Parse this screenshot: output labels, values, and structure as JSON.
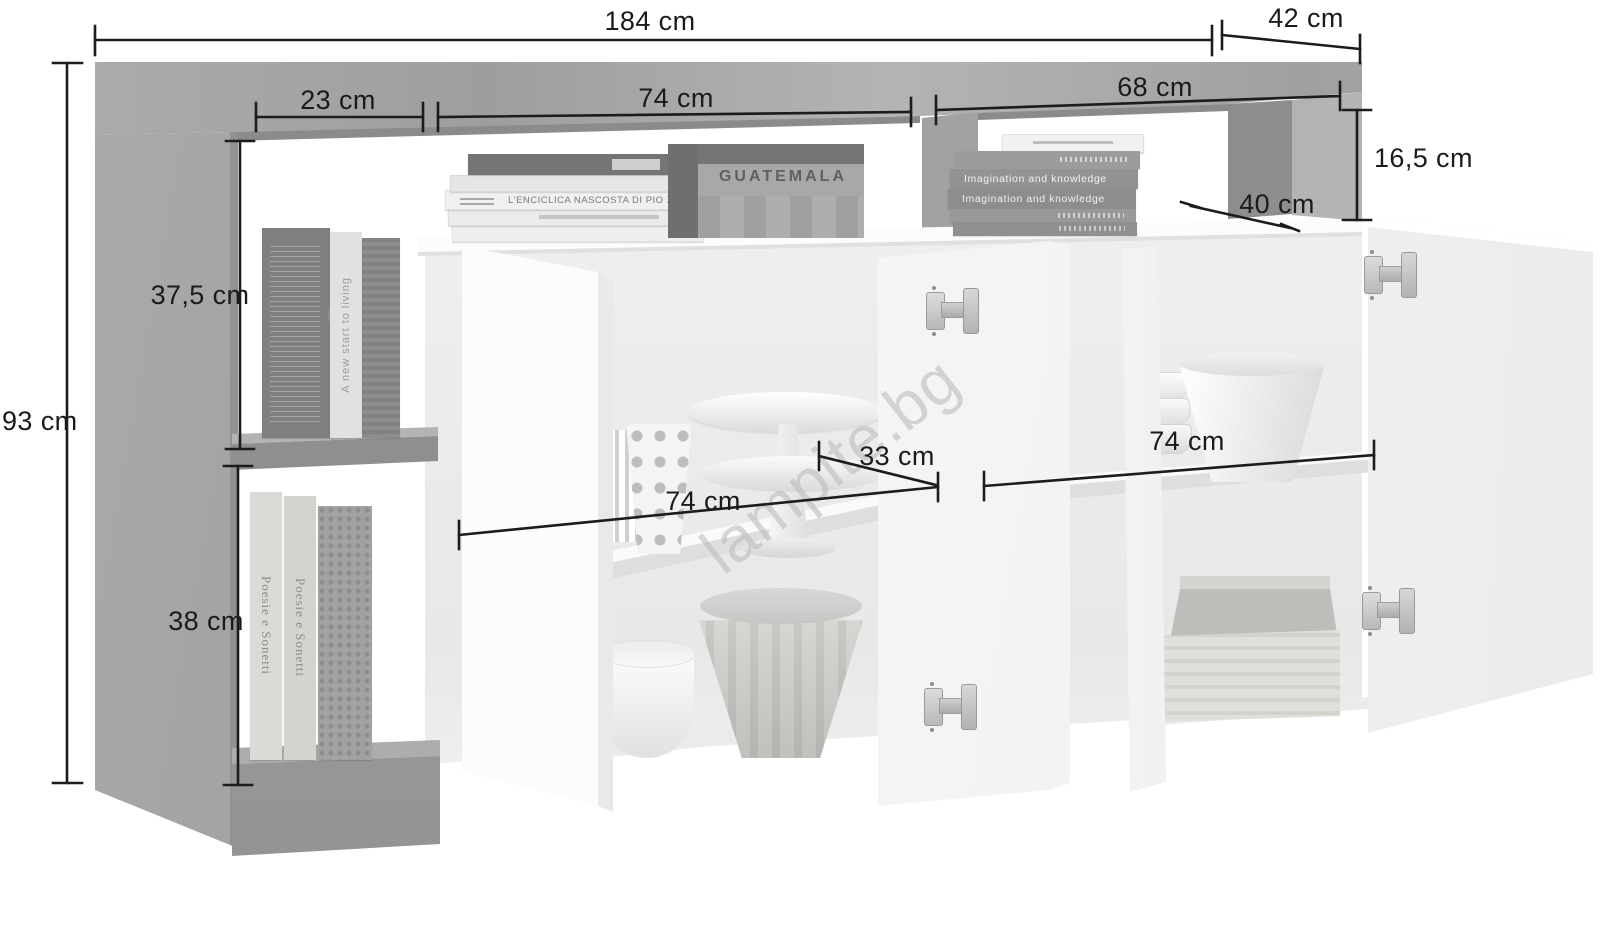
{
  "diagram": {
    "type": "furniture-dimension-diagram",
    "dims": {
      "total_width": "184 cm",
      "total_depth": "42 cm",
      "total_height": "93 cm",
      "left_cubby_width": "23 cm",
      "top_niche_left_width": "74 cm",
      "top_niche_right_width": "68 cm",
      "top_niche_height": "16,5 cm",
      "top_niche_depth": "40 cm",
      "upper_cubby_height": "37,5 cm",
      "lower_cubby_height": "38 cm",
      "left_compartment_width": "74 cm",
      "shelf_depth": "33 cm",
      "right_compartment_width": "74 cm"
    },
    "props": {
      "crate_label": "GUATEMALA",
      "book_enciclica": "L'ENCICLICA NASCOSTA DI PIO XI",
      "book_imagination_1": "Imagination and knowledge",
      "book_imagination_2": "Imagination and knowledge",
      "book_living": "A new start to living",
      "book_poesie_1": "Poesie e Sonetti",
      "book_poesie_2": "Poesie e Sonetti"
    },
    "watermarks": {
      "main": "lampite.bg",
      "fragment": "ed"
    },
    "colors": {
      "concrete": "#a5a5a5",
      "concrete_dark": "#8a8a8a",
      "white_surface": "#fbfbfb",
      "dimension_line": "#1c1c1c",
      "background": "#ffffff"
    }
  }
}
